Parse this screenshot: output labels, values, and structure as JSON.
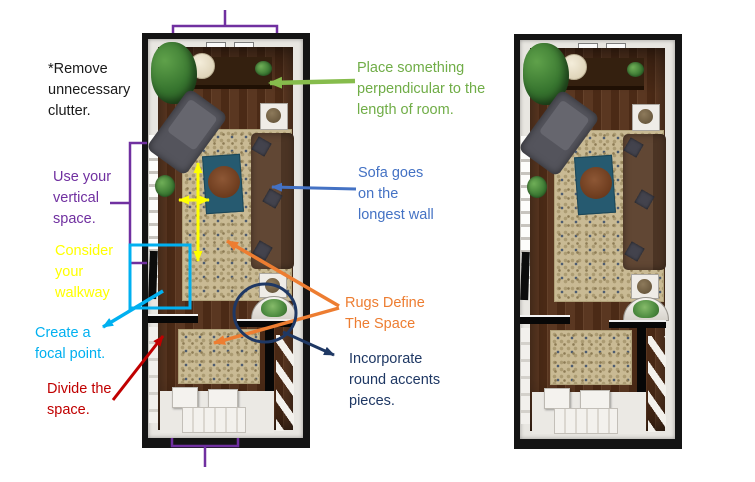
{
  "title_context": "annotated long narrow living room floor plan with interior design tips",
  "colors": {
    "purple": "#7030A0",
    "yellow": "#FFFF00",
    "cyan": "#00B0F0",
    "red": "#C00000",
    "green": "#70AD47",
    "green_arrow": "#86BC4C",
    "blue": "#4472C4",
    "orange": "#ED7D31",
    "navy": "#1F3864",
    "black": "#1a1a1a"
  },
  "annotations": {
    "remove_clutter": {
      "text": "*Remove\nunnecessary\nclutter."
    },
    "vertical_space": {
      "text": "Use your\nvertical\nspace."
    },
    "walkway": {
      "text": "Consider\nyour\nwalkway"
    },
    "focal_point": {
      "text": "Create a\nfocal point."
    },
    "divide_space": {
      "text": "Divide the\nspace."
    },
    "perpendicular": {
      "text": "Place something\nperpendicular to the\nlength of room."
    },
    "sofa_wall": {
      "text": "Sofa goes\non the\nlongest wall"
    },
    "rugs": {
      "text": "Rugs Define\nThe Space"
    },
    "round_accents": {
      "text": "Incorporate\nround accents\npieces."
    }
  }
}
